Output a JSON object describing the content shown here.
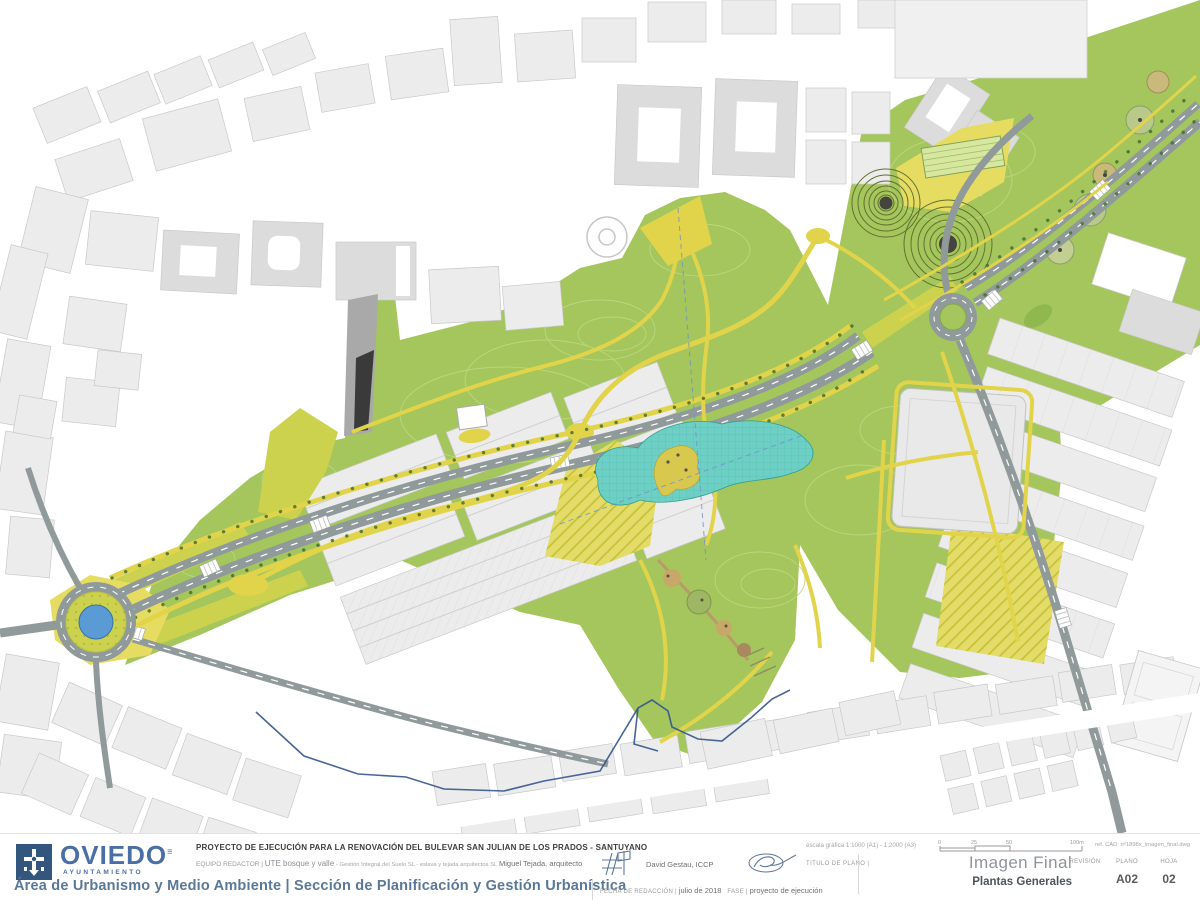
{
  "palette": {
    "park_green": "#a4c65c",
    "chartreuse": "#ccd24d",
    "path_yellow": "#e2d44a",
    "plaza_yellow": "#e6dc62",
    "contour": "#bcd77f",
    "pond_cyan": "#6ed0c5",
    "pond_edge": "#2f9f94",
    "water_blue": "#5b9bd5",
    "road_gray": "#909a9a",
    "fabric_fill": "#ececec",
    "fabric_stroke": "#c9c9c9",
    "fabric_dark": "#dcdcdc",
    "mound_line": "#64702f",
    "mound_dark": "#45453f",
    "tree_dot": "#476f2e",
    "boundary_blue": "#34548c",
    "stream_blue": "#6f8fc9",
    "logo_blue": "#33567e",
    "brand_blue": "#4a6fa5",
    "dept_blue": "#5b7797",
    "title_dark": "#3c3c3c",
    "label_gray": "#9a9a9a",
    "value_gray": "#6e6e6e",
    "imagen_gray": "#8f9499",
    "plantas_dark": "#4f5458"
  },
  "titleblock": {
    "logo": {
      "city": "OVIEDO",
      "subtitle": "AYUNTAMIENTO"
    },
    "department_line": "Área de Urbanismo y Medio Ambiente | Sección de Planificación y Gestión Urbanística",
    "project_title": "PROYECTO DE EJECUCIÓN PARA LA RENOVACIÓN DEL BULEVAR SAN JULIAN DE LOS PRADOS - SANTUYANO",
    "equipo": {
      "label": "EQUIPO REDACTOR",
      "sep": "|",
      "team": "UTE bosque y valle",
      "firms": "- Gestión Integral del Suelo SL - eslava y tejada arquitectos SL",
      "architect": "Miguel Tejada, arquitecto",
      "engineer": "David Gestau, ICCP"
    },
    "titulo_plano": {
      "label": "TITULO DE PLANO",
      "sep": "|"
    },
    "fecha": {
      "label": "FECHA DE REDACCIÓN",
      "sep": "|",
      "value": "julio de 2018"
    },
    "fase": {
      "label": "FASE",
      "sep": "|",
      "value": "proyecto de ejecución"
    },
    "escala": {
      "label": "escala gráfica",
      "value": "1:1000 (A1) - 1:2000 (A3)"
    },
    "scalebar": {
      "labels": [
        "0",
        "25",
        "50",
        "100m"
      ]
    },
    "ref_cad": "ref. CAD: nº1898x_imagen_final.dwg",
    "plano_name": "Imagen Final",
    "plano_subname": "Plantas Generales",
    "revision": {
      "label": "REVISIÓN",
      "value": ""
    },
    "plano": {
      "label": "PLANO",
      "value": "A02"
    },
    "hoja": {
      "label": "HOJA",
      "value": "02"
    }
  }
}
